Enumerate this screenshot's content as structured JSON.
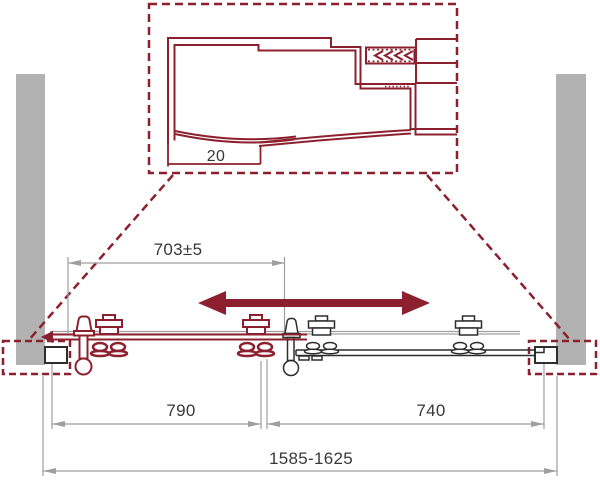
{
  "drawing": {
    "type_label": "sliding-door-installation-scheme",
    "detail": {
      "offset_label": "20"
    },
    "dimensions": {
      "travel": "703±5",
      "sliding_panel": "790",
      "fixed_panel": "740",
      "overall": "1585-1625"
    }
  },
  "icons": {
    "slide_direction": "double-headed-arrow",
    "gasket_insertion": "triple-chevron-left"
  },
  "colors": {
    "accent_red": "#8d202f",
    "wall_gray": "#b2b2b2",
    "dim_gray": "#9e9e9e",
    "outline_dark": "#2d2d2d",
    "rail_gray": "#a0a0a0",
    "text": "#383838",
    "background": "#ffffff"
  }
}
